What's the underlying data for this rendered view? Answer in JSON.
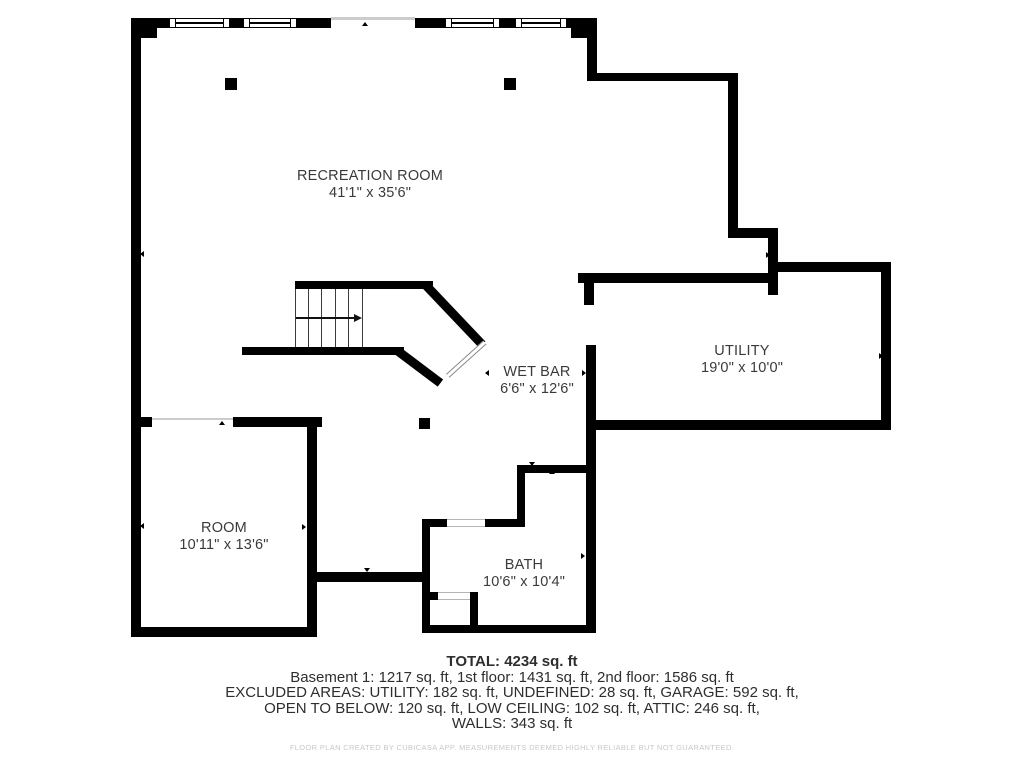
{
  "rooms": [
    {
      "name": "RECREATION ROOM",
      "dims": "41'1\" x 35'6\""
    },
    {
      "name": "UTILITY",
      "dims": "19'0\" x 10'0\""
    },
    {
      "name": "WET BAR",
      "dims": "6'6\" x 12'6\""
    },
    {
      "name": "ROOM",
      "dims": "10'11\" x 13'6\""
    },
    {
      "name": "BATH",
      "dims": "10'6\" x 10'4\""
    }
  ],
  "summary": {
    "total": "TOTAL: 4234 sq. ft",
    "floors": "Basement 1: 1217 sq. ft, 1st floor: 1431 sq. ft, 2nd floor: 1586 sq. ft",
    "excluded_line1": "EXCLUDED AREAS: UTILITY: 182 sq. ft, UNDEFINED: 28 sq. ft, GARAGE: 592 sq. ft,",
    "excluded_line2": "OPEN TO BELOW: 120 sq. ft, LOW CEILING: 102 sq. ft, ATTIC: 246 sq. ft,",
    "walls_line": "WALLS: 343 sq. ft"
  },
  "footer": {
    "disclaimer": "FLOOR PLAN CREATED BY CUBICASA APP. MEASUREMENTS DEEMED HIGHLY RELIABLE BUT NOT GUARANTEED."
  },
  "colors": {
    "wall": "#000000",
    "label_text": "#3a3a3a",
    "summary_text": "#2e2e2e",
    "opening_line": "#cccccc",
    "disclaimer_text": "#c8c8c8"
  }
}
